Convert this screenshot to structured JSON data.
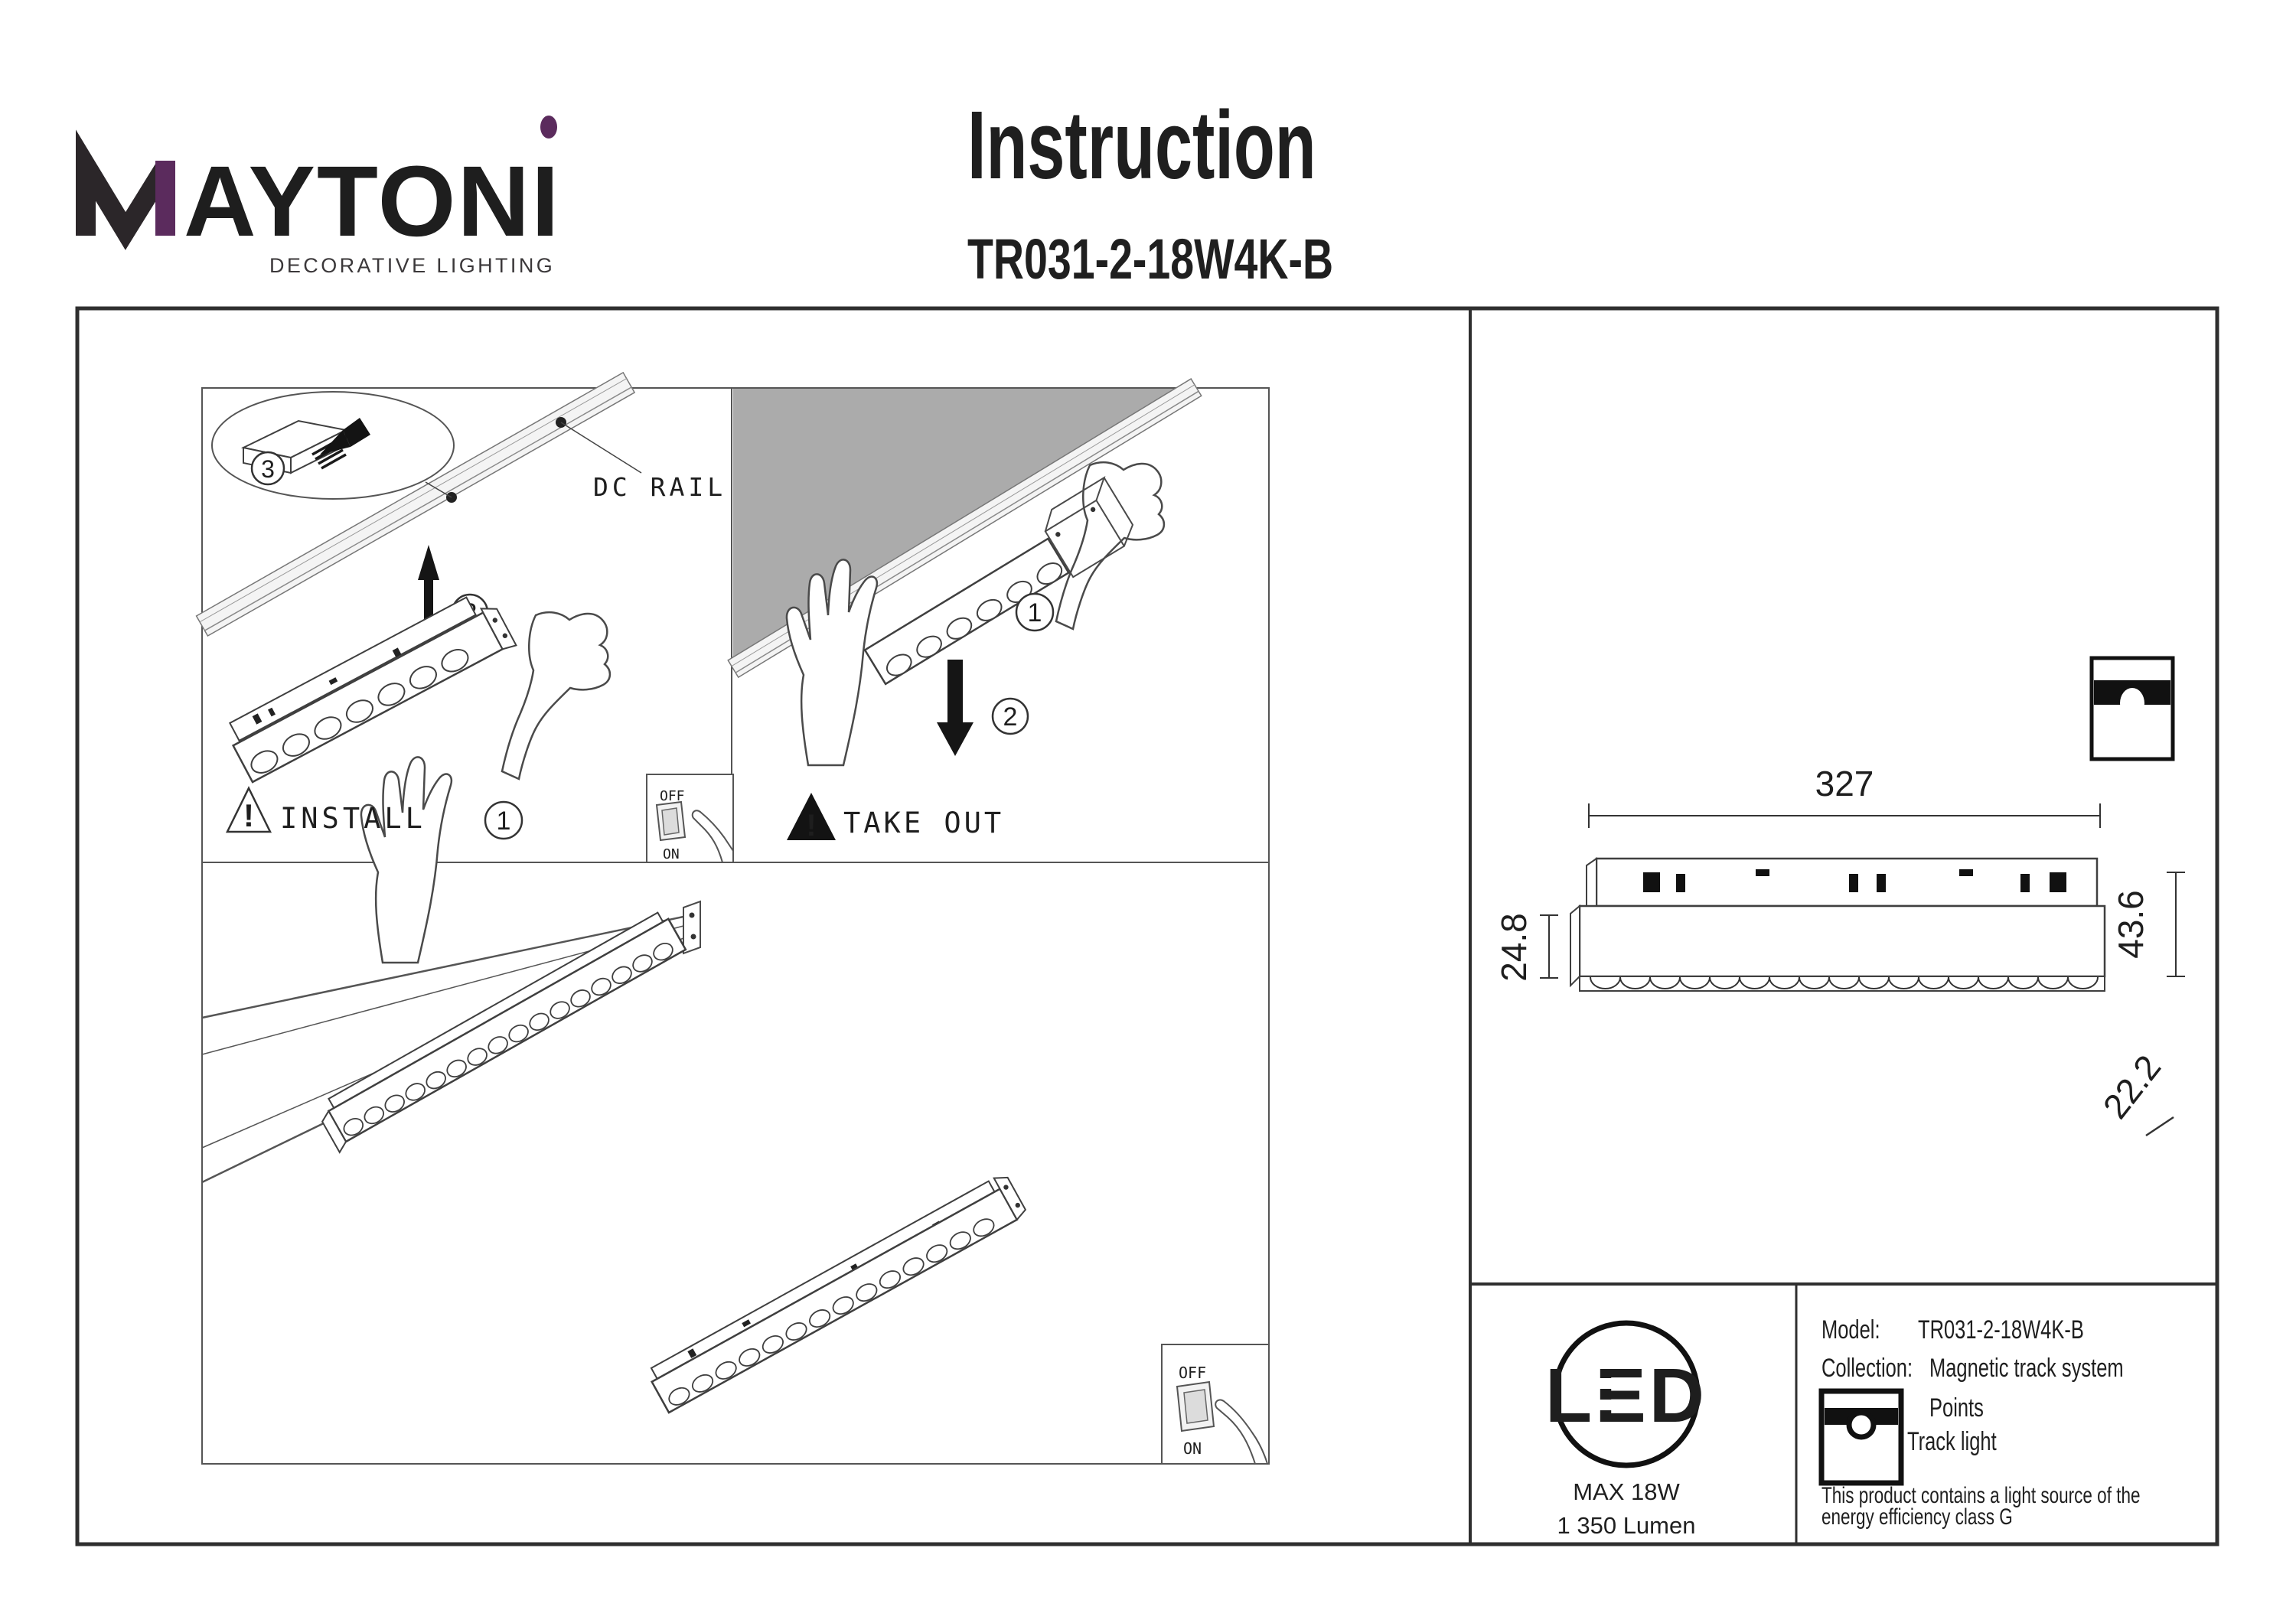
{
  "colors": {
    "accent": "#5b2b5d",
    "ink": "#1f1f1f",
    "sketch": "#3f3f3f",
    "ceiling_gray": "#ababab"
  },
  "brand": {
    "name": "MAYTONI",
    "name_rest": "AYTONI",
    "tagline": "DECORATIVE LIGHTING"
  },
  "header": {
    "title": "Instruction",
    "model_code": "TR031-2-18W4K-B"
  },
  "install_panel": {
    "caption": "INSTALL",
    "rail_label": "DC RAIL",
    "step_1": "1",
    "step_2": "2",
    "step_3": "3",
    "switch_off": "OFF",
    "switch_on": "ON"
  },
  "takeout_panel": {
    "caption": "TAKE OUT",
    "step_1": "1",
    "step_2": "2"
  },
  "overview_panel": {
    "switch_off": "OFF",
    "switch_on": "ON"
  },
  "dimensions": {
    "length": "327",
    "front_height": "24.8",
    "total_height": "43.6",
    "depth": "22.2"
  },
  "spec": {
    "led_badge": "LED",
    "max_power": "MAX 18W",
    "luminous_flux": "1 350 Lumen",
    "model_label": "Model:",
    "model_value": "TR031-2-18W4K-B",
    "collection_label": "Collection:",
    "collection_value": "Magnetic track system",
    "family": "Points",
    "type": "Track light",
    "note_line1": "This product contains a light source of the",
    "note_line2": "energy efficiency class G"
  }
}
